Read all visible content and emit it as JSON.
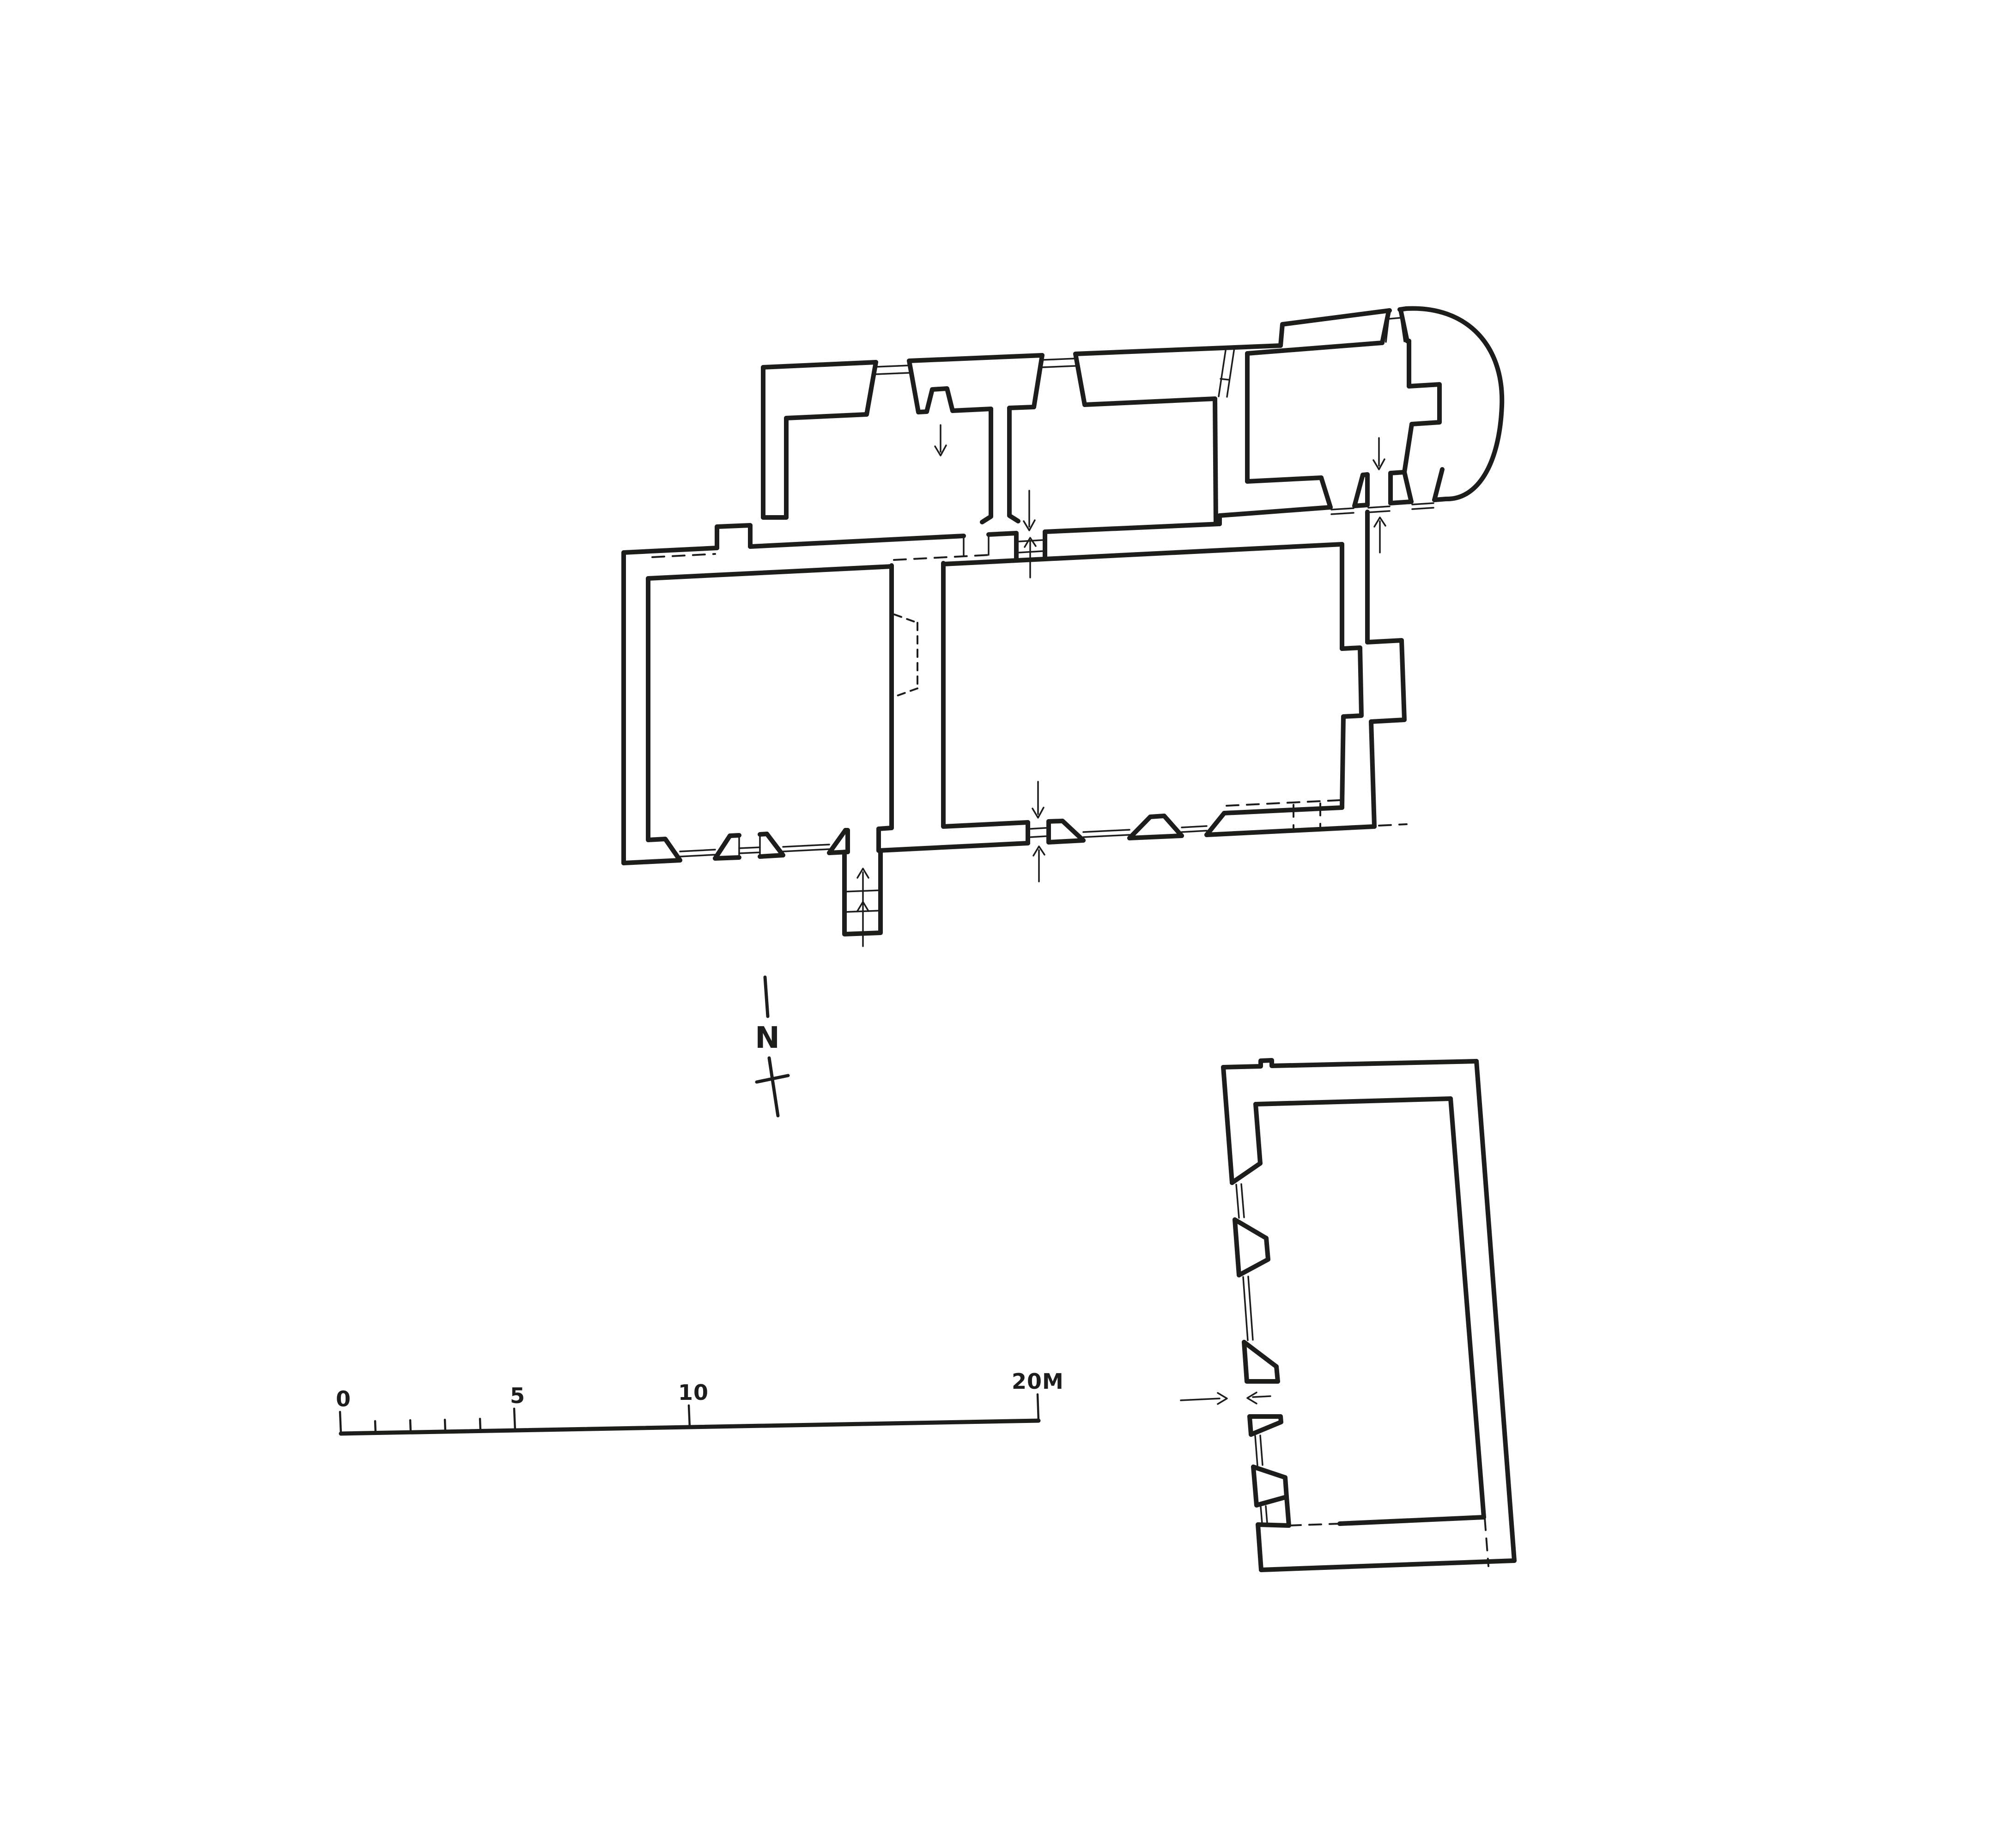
{
  "page": {
    "background": "#ffffff",
    "ink": "#1d1d1b",
    "drawing_type": "measured floor plan sheet, two buildings"
  },
  "north_arrow": {
    "label": "N"
  },
  "scale_bar": {
    "unit": "M",
    "labels": [
      "0",
      "5",
      "10",
      "20M"
    ],
    "major_ticks_meters": [
      0,
      5,
      10,
      20
    ],
    "minor_ticks_meters": [
      1,
      2,
      3,
      4
    ]
  },
  "plans": {
    "church": {
      "name": "church-plan",
      "parts": [
        "north-range",
        "nave-two-rooms",
        "chancel",
        "apse",
        "south-porch-steps",
        "altar-niche"
      ]
    },
    "outbuilding": {
      "name": "outbuilding-plan",
      "parts": [
        "tilted-rectangular-hall",
        "west-wall-windows",
        "west-door"
      ]
    }
  }
}
